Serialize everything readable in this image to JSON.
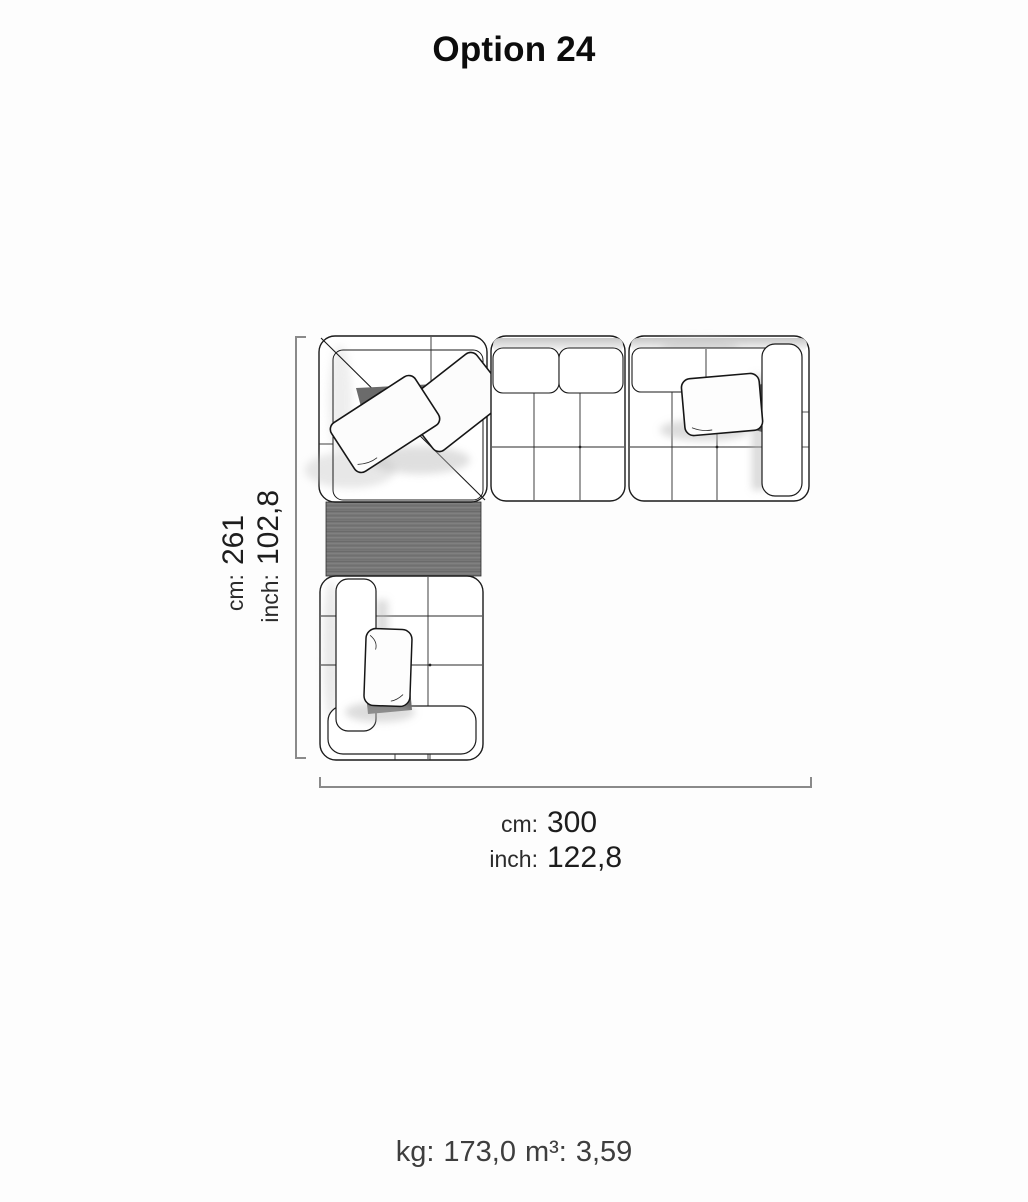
{
  "title": "Option 24",
  "diagram": {
    "height_dimension": {
      "unit_cm": "cm:",
      "value_cm": "261",
      "unit_inch": "inch:",
      "value_inch": "102,8"
    },
    "width_dimension": {
      "unit_cm": "cm:",
      "value_cm": "300",
      "unit_inch": "inch:",
      "value_inch": "122,8"
    }
  },
  "footer": {
    "weight_label": "kg:",
    "weight_value": "173,0",
    "volume_label": "m³:",
    "volume_value": "3,59"
  },
  "colors": {
    "background": "#fdfdfd",
    "title_text": "#0c0c0c",
    "dimension_text": "#222222",
    "dimension_line": "#8a8a8a",
    "sofa_outline": "#1a1a1a",
    "wood_table": "#777777",
    "footer_text": "#3e3e3e"
  }
}
